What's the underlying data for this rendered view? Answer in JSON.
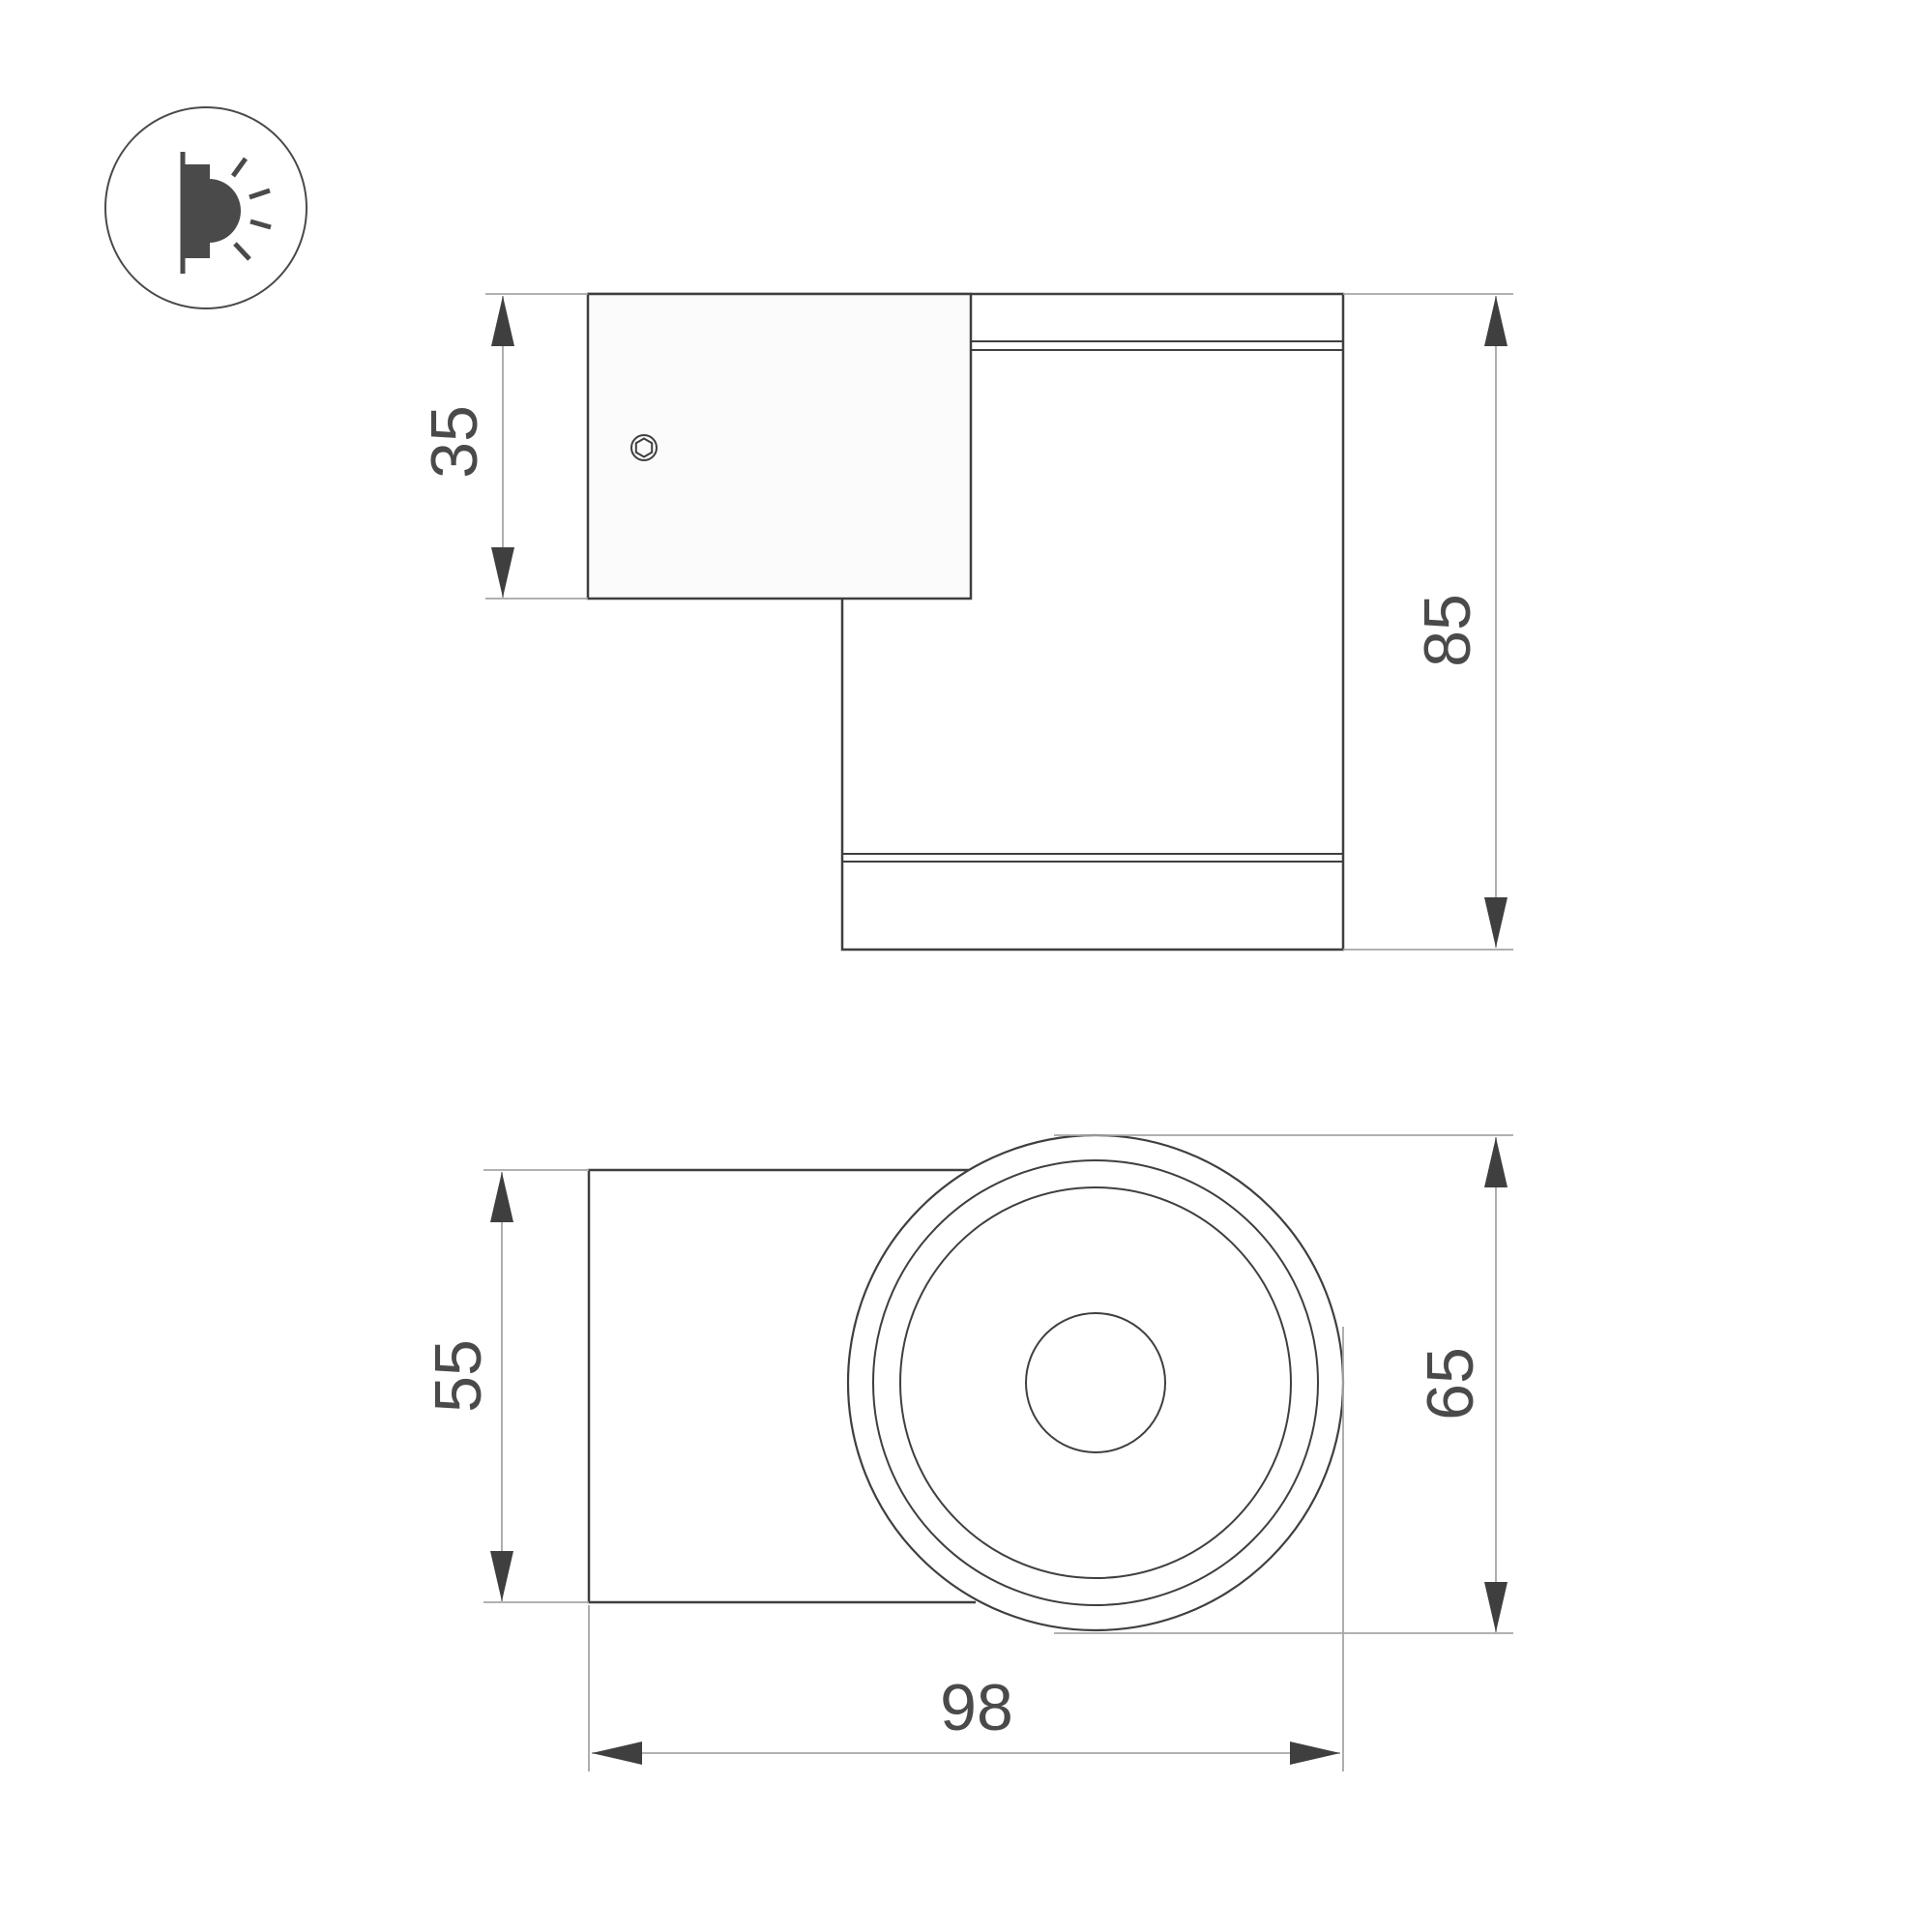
{
  "page": {
    "background": "#ffffff",
    "type": "technical dimension drawing"
  },
  "colors": {
    "object_line": "#3f3f3f",
    "dimension_line": "#a6a6a6",
    "arrow": "#3f3f3f",
    "text": "#4a4a4a",
    "plate_fill": "#fbfbfb",
    "background": "#ffffff"
  },
  "icon": {
    "name": "wall-mounted-light-emitting-icon"
  },
  "views": {
    "side": {
      "dimensions": {
        "bracket_height": {
          "value": "35",
          "orientation": "vertical"
        },
        "total_height": {
          "value": "85",
          "orientation": "vertical"
        }
      }
    },
    "front": {
      "dimensions": {
        "bracket_width": {
          "value": "55",
          "orientation": "vertical"
        },
        "body_diameter": {
          "value": "65",
          "orientation": "vertical"
        },
        "total_depth": {
          "value": "98",
          "orientation": "horizontal"
        }
      }
    }
  }
}
